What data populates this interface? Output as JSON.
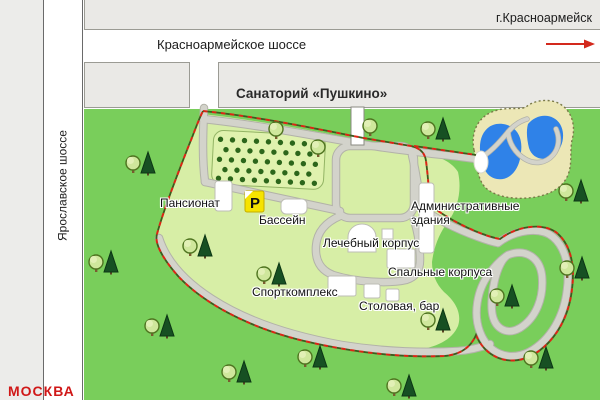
{
  "top": {
    "city_label": "г.Красноармейск",
    "highway_label": "Красноармейское шоссе"
  },
  "left": {
    "highway_label": "Ярославское шоссе",
    "moscow_label": "МОСКВА"
  },
  "resort": {
    "title": "Санаторий «Пушкино»",
    "parking_label": "P"
  },
  "map_labels": [
    {
      "id": "pansionat",
      "text": "Пансионат"
    },
    {
      "id": "bassein",
      "text": "Бассейн"
    },
    {
      "id": "lechebny-korpus",
      "text": "Лечебный корпус"
    },
    {
      "id": "spalnye-korpusa",
      "text": "Спальные корпуса"
    },
    {
      "id": "admin-line1",
      "text": "Административные"
    },
    {
      "id": "admin-line2",
      "text": "здания"
    },
    {
      "id": "sportkompleks",
      "text": "Спорткомплекс"
    },
    {
      "id": "stolovaya-bar",
      "text": "Столовая, бар"
    }
  ],
  "colors": {
    "forest_green": "#79ce5b",
    "territory_green": "#d7eea6",
    "orchard_green": "#e0f2ae",
    "road_gray": "#d3d3cb",
    "block_gray": "#eae9e6",
    "pond_blue": "#2f82e8",
    "sand": "#ece7b6",
    "fence_red": "#dc2414",
    "parking_yellow": "#f6e300",
    "moscow_red": "#d01818"
  }
}
